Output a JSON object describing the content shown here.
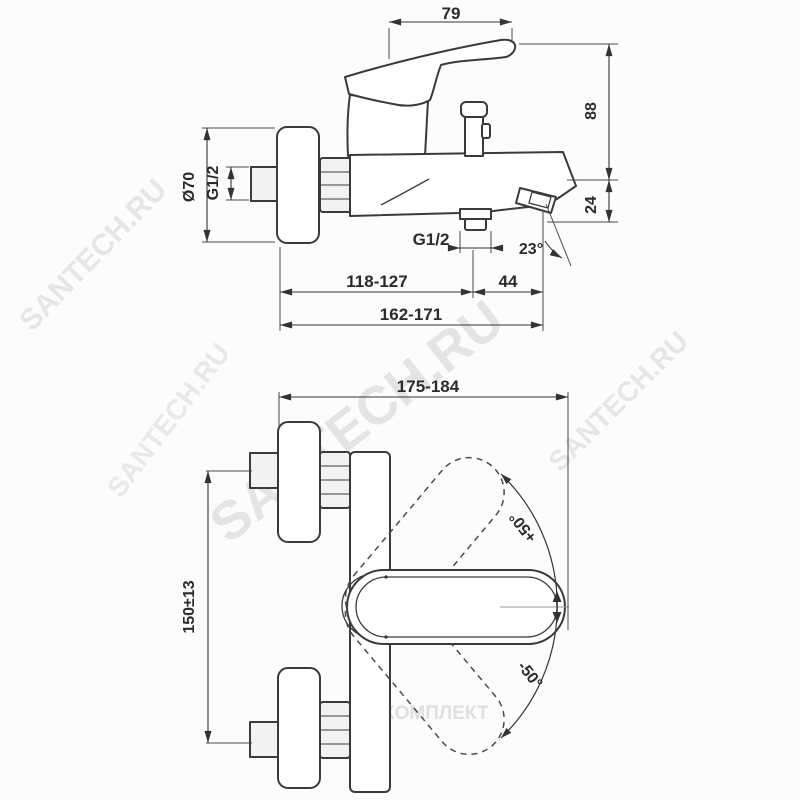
{
  "labels": {
    "dim_79": "79",
    "dim_88": "88",
    "dim_24": "24",
    "dim_dia70": "Ø70",
    "dim_g12_inlet": "G1/2",
    "dim_g12_outlet": "G1/2",
    "dim_angle23": "23°",
    "dim_44": "44",
    "dim_118_127": "118-127",
    "dim_162_171": "162-171",
    "dim_175_184": "175-184",
    "dim_150_13": "150±13",
    "dim_plus50": "+50°",
    "dim_minus50": "-50°"
  },
  "watermarks": {
    "brand": "SANTECH.RU",
    "copyright": "©САНТЕХКОМПЛЕКТ"
  },
  "colors": {
    "line": "#3a3a3a",
    "dimension": "#333333",
    "watermark": "#cdcdcd",
    "background": "#fcfcfc"
  }
}
